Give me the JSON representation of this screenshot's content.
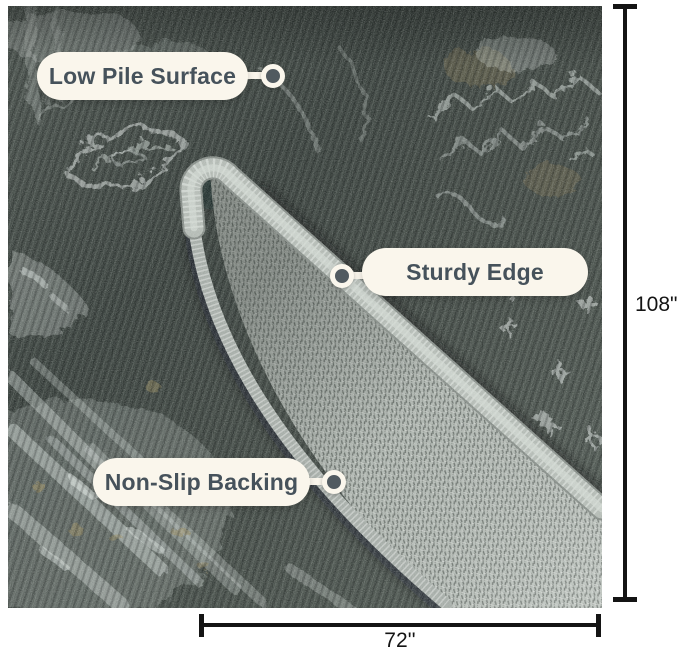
{
  "product_annotations": {
    "callouts": [
      {
        "label": "Low Pile Surface"
      },
      {
        "label": "Sturdy Edge"
      },
      {
        "label": "Non-Slip Backing"
      }
    ],
    "dimensions": {
      "height": "108\"",
      "width": "72''"
    }
  },
  "icons": {
    "connector_dot": "filled-circle-with-ring",
    "dimension_caps": "t-bar-end-caps"
  },
  "colors": {
    "canvas_bg": "#ffffff",
    "pill_bg": "#faf6ec",
    "pill_text": "#46525b",
    "dot_fill": "#515a60",
    "dim_line": "#141414",
    "rug_dark": "#3a423e",
    "rug_pattern": "#d8dfdc",
    "rug_accent_tan": "#8a7c57",
    "backing_gray": "#b7beb8",
    "serge_edge": "#b3bab4"
  }
}
